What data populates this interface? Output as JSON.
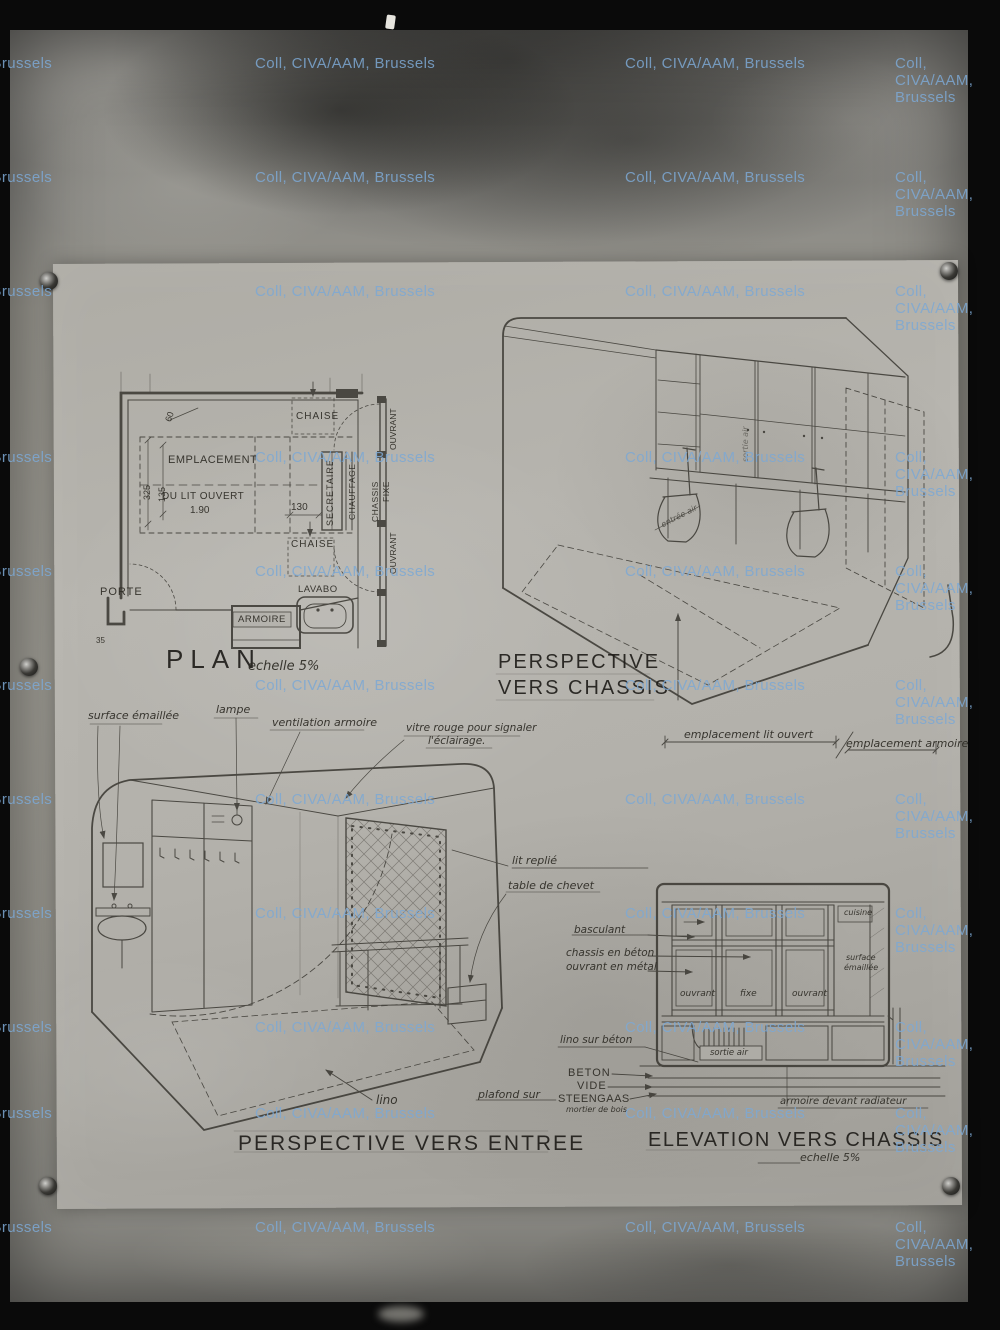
{
  "colors": {
    "ink": "#383630",
    "sheet": "#b2b0aa",
    "plate": "#95938c",
    "frame": "#0a0a0a",
    "watermark": "#7ca8d4"
  },
  "watermark": {
    "text": "Coll, CIVA/AAM, Brussels",
    "rows": [
      55,
      169,
      283,
      449,
      563,
      677,
      791,
      905,
      1019,
      1105,
      1219
    ],
    "cols": [
      -128,
      255,
      625,
      895
    ]
  },
  "plan": {
    "title": "PLAN",
    "scale": "echelle 5%",
    "labels": {
      "chaise_top": "CHAISE",
      "chaise_bottom": "CHAISE",
      "emplacement_l1": "EMPLACEMENT",
      "emplacement_l2": "DU LIT OUVERT",
      "emplacement_l3": "1.90",
      "porte": "PORTE",
      "lavabo": "LAVABO",
      "armoire": "ARMOIRE",
      "secretaire": "SECRETAIRE",
      "chauffage": "CHAUFFAGE",
      "chassis": "CHASSIS",
      "fixe": "FIXE",
      "ouvrant_top": "OUVRANT",
      "ouvrant_bottom": "OUVRANT"
    },
    "dims": {
      "d325": "325",
      "d135": "135",
      "d60": "60",
      "d130": "130",
      "d35": "35"
    }
  },
  "perspective_chassis": {
    "title_l1": "PERSPECTIVE",
    "title_l2": "VERS CHASSIS",
    "labels": {
      "entree_air": "entrée air",
      "sortie_air": "sortie air",
      "emplacement_lit": "emplacement lit ouvert",
      "emplacement_armoire": "emplacement armoire"
    }
  },
  "perspective_entree": {
    "title": "PERSPECTIVE VERS ENTREE",
    "labels": {
      "surface_emaillee": "surface émaillée",
      "lampe": "lampe",
      "ventilation": "ventilation armoire",
      "vitre_l1": "vitre rouge pour signaler",
      "vitre_l2": "l'éclairage.",
      "lit_replie": "lit replié",
      "table_chevet": "table de chevet",
      "lino": "lino"
    }
  },
  "elevation": {
    "title": "ELEVATION VERS CHASSIS",
    "scale": "echelle 5%",
    "labels": {
      "basculant": "basculant",
      "chassis_beton": "chassis en béton",
      "ouvrant_metal": "ouvrant en métal",
      "ouvrant_left": "ouvrant",
      "fixe": "fixe",
      "ouvrant_right": "ouvrant",
      "sortie_air": "sortie air",
      "lino_beton": "lino sur béton",
      "beton": "BETON",
      "vide": "VIDE",
      "steengaas": "STEENGAAS",
      "mortier": "mortier de bois",
      "plafond": "plafond sur",
      "armoire_radiateur": "armoire devant radiateur",
      "cuisine": "cuisine",
      "surface_l1": "surface",
      "surface_l2": "émaillée"
    }
  }
}
